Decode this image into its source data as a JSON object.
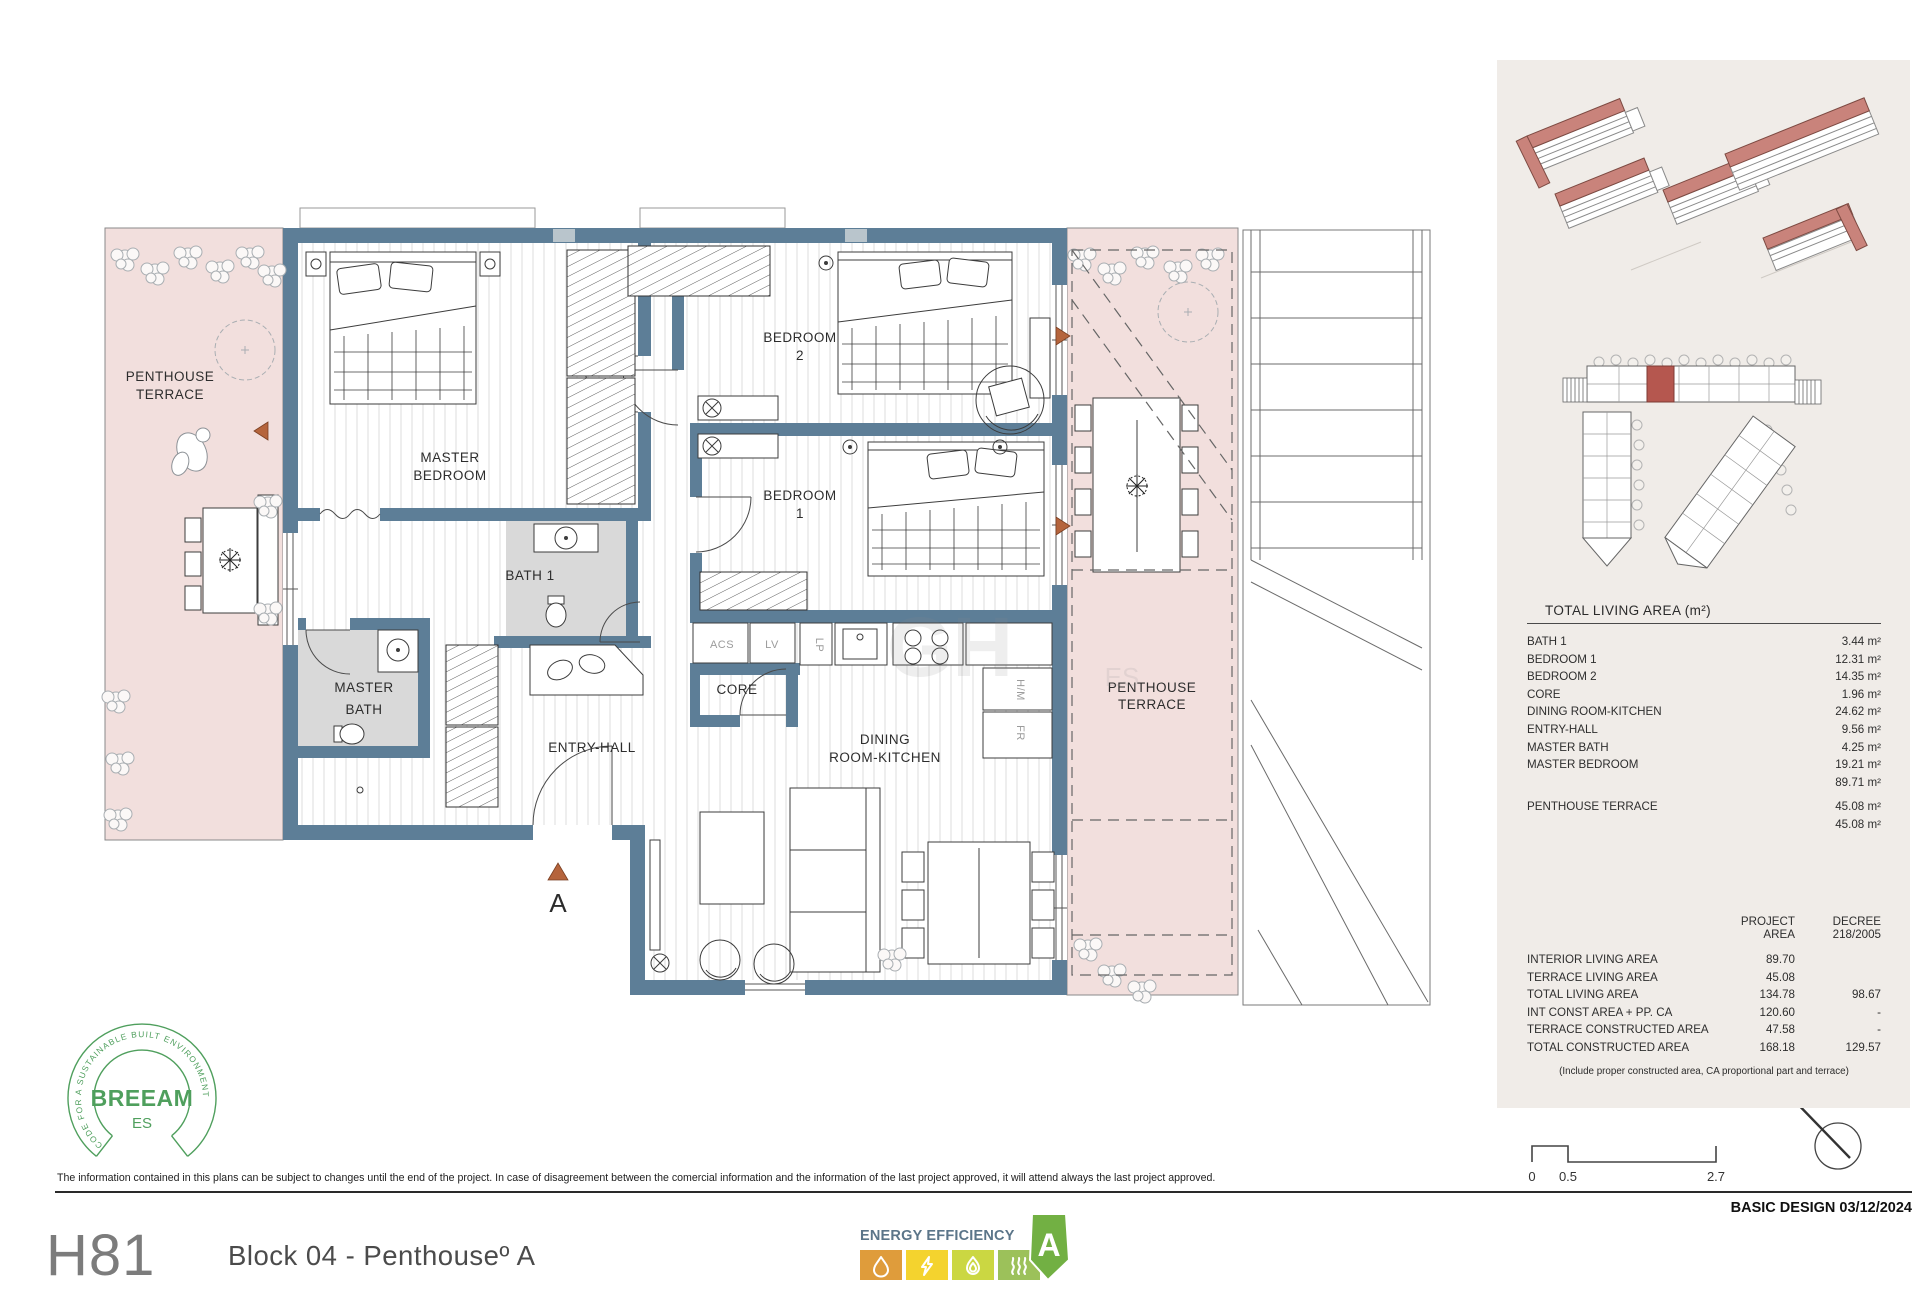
{
  "footer": {
    "code": "H81",
    "block": "Block 04 -  Penthouseº A",
    "design": "BASIC DESIGN 03/12/2024",
    "disclaimer": "The information contained in this plans can be subject to changes until the end of the project. In case of disagreement between the comercial information and the information of the last project approved, it will attend always the last project approved."
  },
  "plan": {
    "rooms": {
      "terrace_left": {
        "l1": "PENTHOUSE",
        "l2": "TERRACE"
      },
      "master_bedroom": {
        "l1": "MASTER",
        "l2": "BEDROOM"
      },
      "bedroom2": {
        "l1": "BEDROOM",
        "l2": "2"
      },
      "bedroom1": {
        "l1": "BEDROOM",
        "l2": "1"
      },
      "bath1": {
        "l1": "BATH 1"
      },
      "master_bath": {
        "l1": "MASTER",
        "l2": "BATH"
      },
      "entry_hall": {
        "l1": "ENTRY-HALL"
      },
      "core": {
        "l1": "CORE"
      },
      "dining": {
        "l1": "DINING",
        "l2": "ROOM-KITCHEN"
      },
      "terrace_right": {
        "l1": "PENTHOUSE",
        "l2": "TERRACE"
      }
    },
    "fixtures": {
      "acs": "ACS",
      "lv": "LV",
      "lp": "LP",
      "hm": "H/M",
      "fr": "FR"
    },
    "entry_marker": "A",
    "compass_n": "N",
    "watermark": {
      "a": "GH",
      "b": "ES"
    }
  },
  "area_table": {
    "title": "TOTAL LIVING AREA (m²)",
    "rows": [
      {
        "label": "BATH 1",
        "value": "3.44 m²"
      },
      {
        "label": "BEDROOM 1",
        "value": "12.31 m²"
      },
      {
        "label": "BEDROOM 2",
        "value": "14.35 m²"
      },
      {
        "label": "CORE",
        "value": "1.96 m²"
      },
      {
        "label": "DINING ROOM-KITCHEN",
        "value": "24.62 m²"
      },
      {
        "label": "ENTRY-HALL",
        "value": "9.56 m²"
      },
      {
        "label": "MASTER BATH",
        "value": "4.25 m²"
      },
      {
        "label": "MASTER BEDROOM",
        "value": "19.21 m²"
      },
      {
        "label": "",
        "value": "89.71 m²"
      },
      {
        "label": "PENTHOUSE TERRACE",
        "value": "45.08 m²"
      },
      {
        "label": "",
        "value": "45.08 m²"
      }
    ]
  },
  "summary_table": {
    "header": {
      "p1": "PROJECT",
      "p2": "AREA",
      "d1": "DECREE",
      "d2": "218/2005"
    },
    "rows": [
      {
        "label": "INTERIOR LIVING AREA",
        "project": "89.70",
        "decree": ""
      },
      {
        "label": "TERRACE LIVING AREA",
        "project": "45.08",
        "decree": ""
      },
      {
        "label": "TOTAL LIVING AREA",
        "project": "134.78",
        "decree": "98.67"
      },
      {
        "label": "INT CONST AREA + PP. CA",
        "project": "120.60",
        "decree": "-"
      },
      {
        "label": "TERRACE CONSTRUCTED AREA",
        "project": "47.58",
        "decree": "-"
      },
      {
        "label": "TOTAL CONSTRUCTED AREA",
        "project": "168.18",
        "decree": "129.57"
      }
    ],
    "footnote": "(Include proper constructed area, CA proportional part and terrace)"
  },
  "scalebar": {
    "t0": "0",
    "t1": "0.5",
    "t2": "2.7"
  },
  "breeam": {
    "name": "BREEAM",
    "region": "ES",
    "arc": "CODE FOR A SUSTAINABLE BUILT ENVIRONMENT"
  },
  "energy": {
    "title": "ENERGY EFFICIENCY",
    "rating": "A"
  },
  "colors": {
    "wall": "#5d7e97",
    "terrace": "#f2dfdd",
    "bath_floor": "#d9d9d9",
    "panel": "#f0ece8",
    "marker": "#b5643c",
    "roof": "#c9837b",
    "unit_red": "#b5574f",
    "breeam_green": "#4f9f5d",
    "energy_text": "#5b7589",
    "energy_orange": "#df9c3b",
    "energy_yellow": "#f4d32e",
    "energy_lime": "#cbd742",
    "energy_green": "#9cc15a",
    "energy_arrow": "#72b043"
  }
}
